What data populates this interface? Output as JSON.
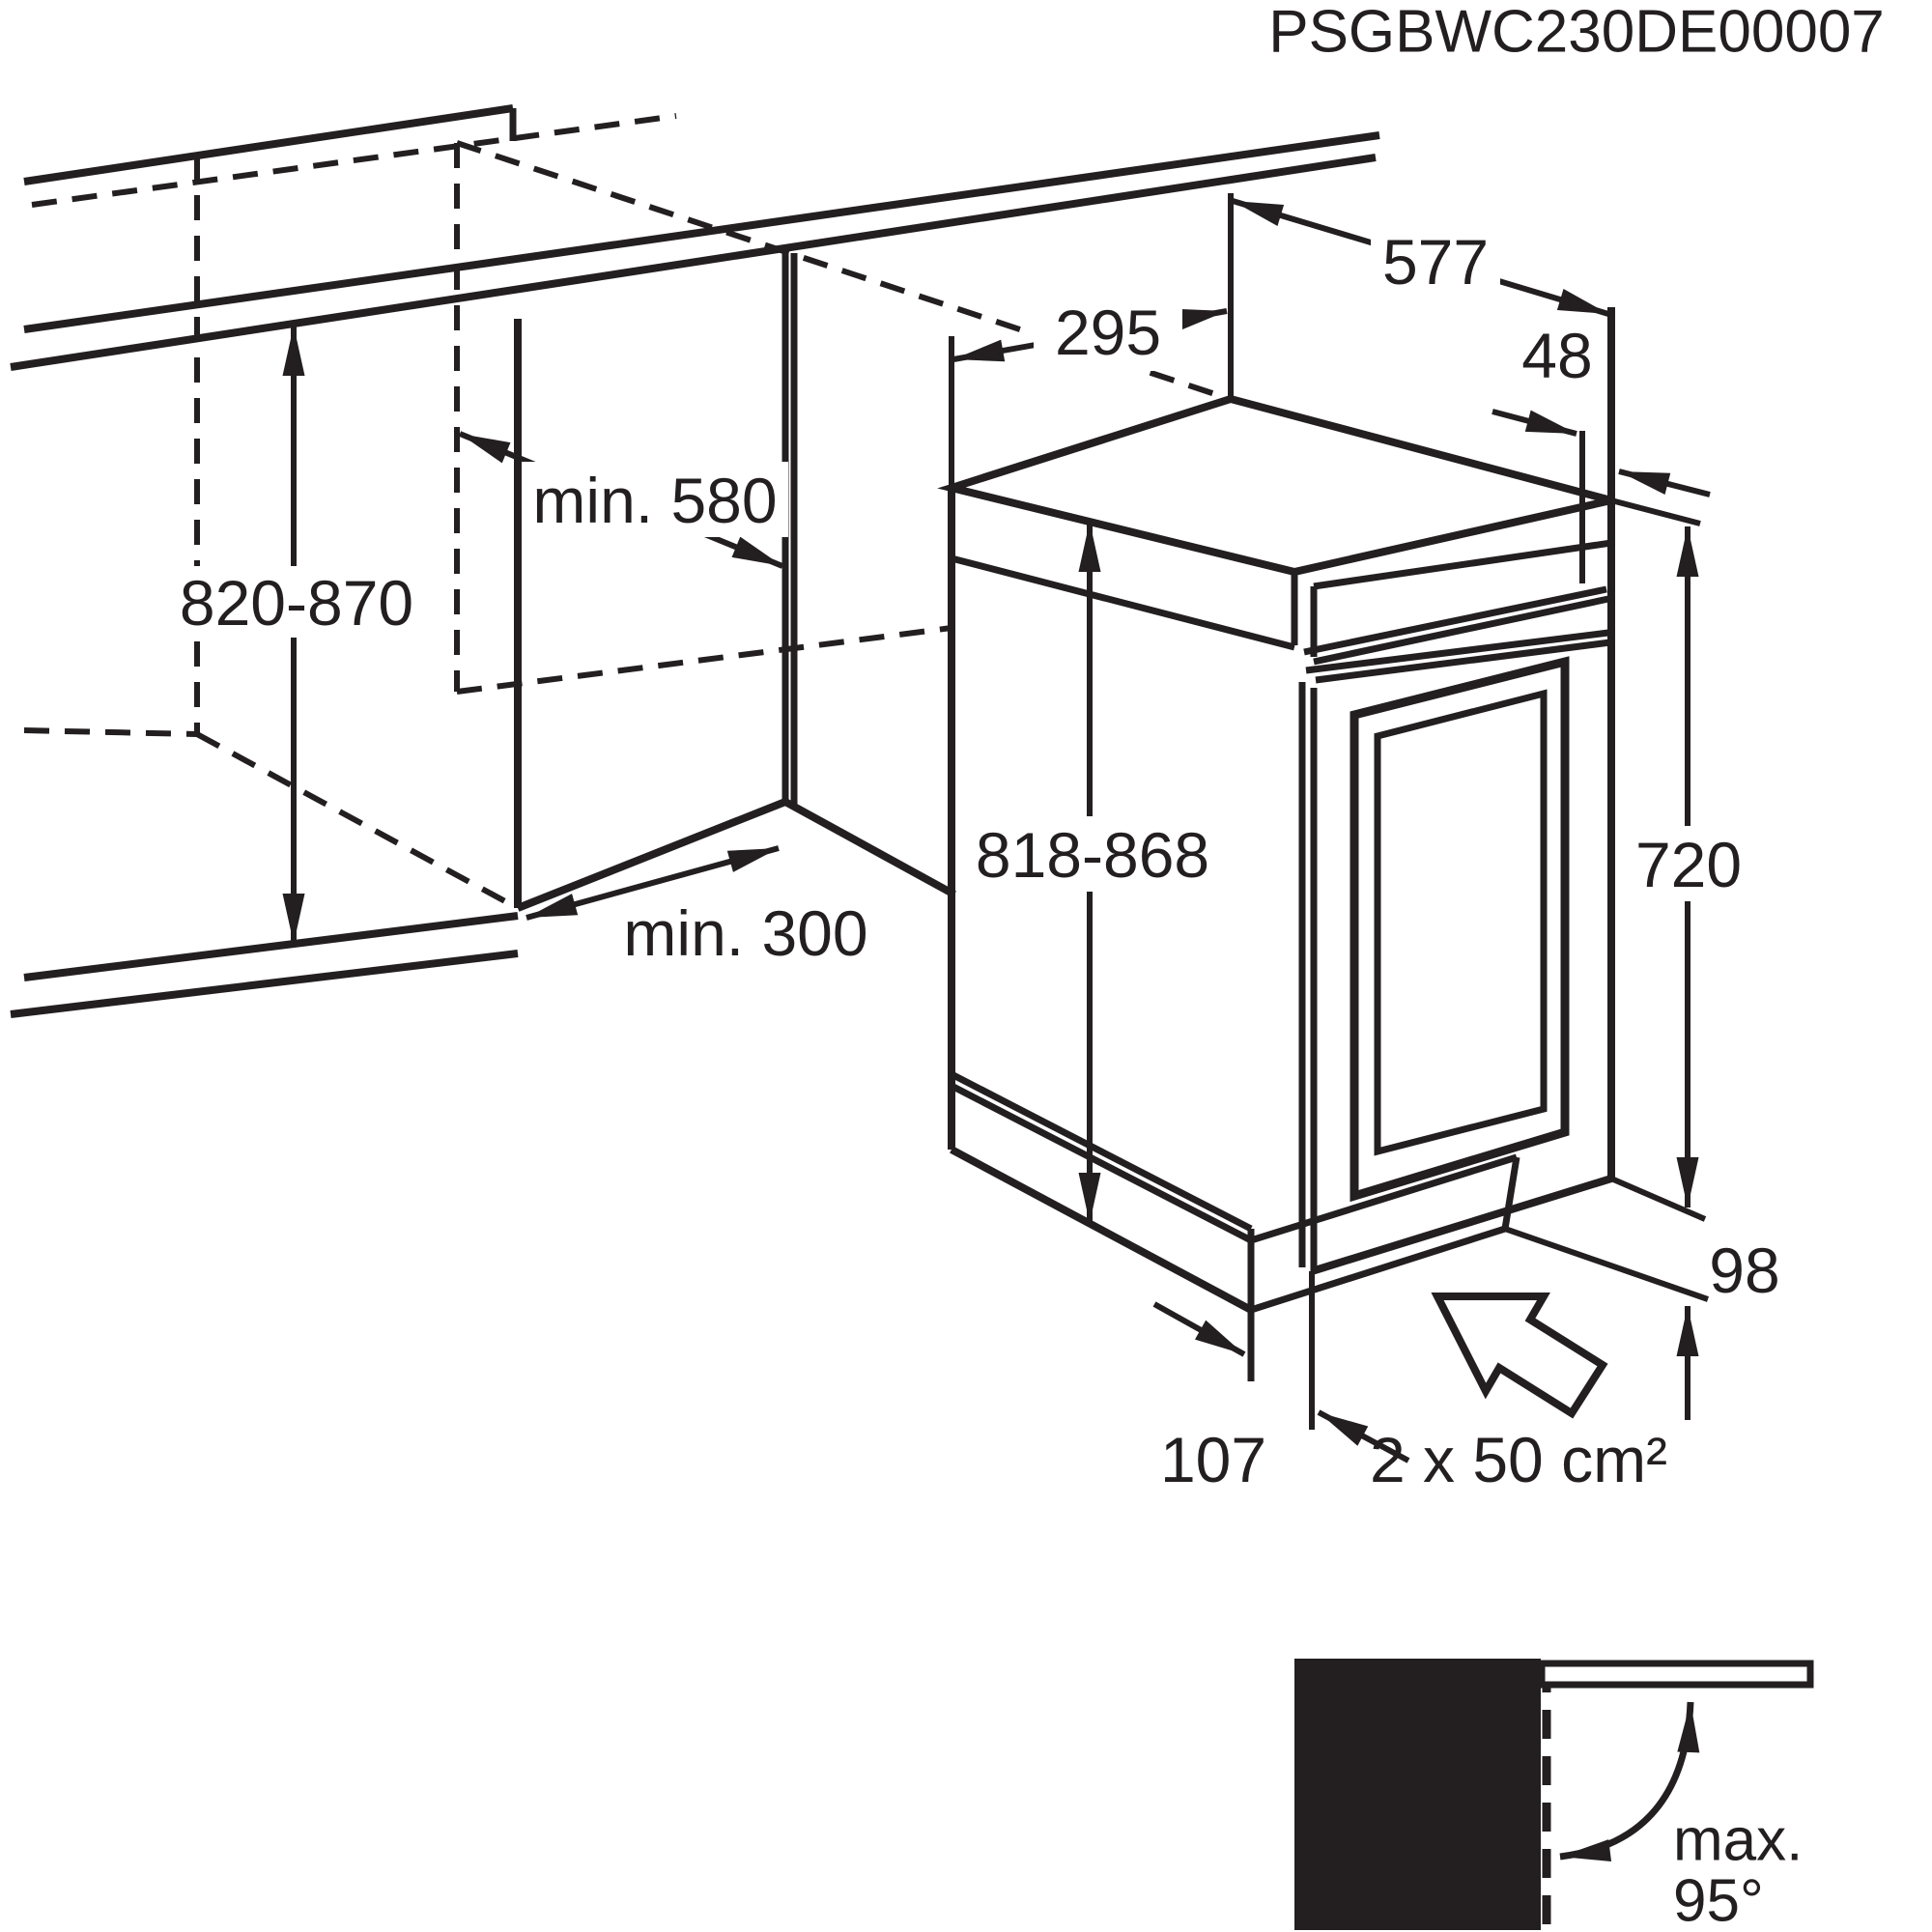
{
  "colors": {
    "ink": "#231f20",
    "paper": "#ffffff"
  },
  "labels": {
    "model_code": "PSGBWC230DE00007",
    "top_width": "577",
    "top_depth": "295",
    "top_gap": "48",
    "niche_height": "820-870",
    "niche_depth": "min. 580",
    "niche_width": "min. 300",
    "appliance_height": "818-868",
    "door_height": "720",
    "plinth_height": "98",
    "plinth_depth": "107",
    "vent_area": "2 x 50 cm²",
    "door_angle_line1": "max.",
    "door_angle_line2": "95°"
  }
}
